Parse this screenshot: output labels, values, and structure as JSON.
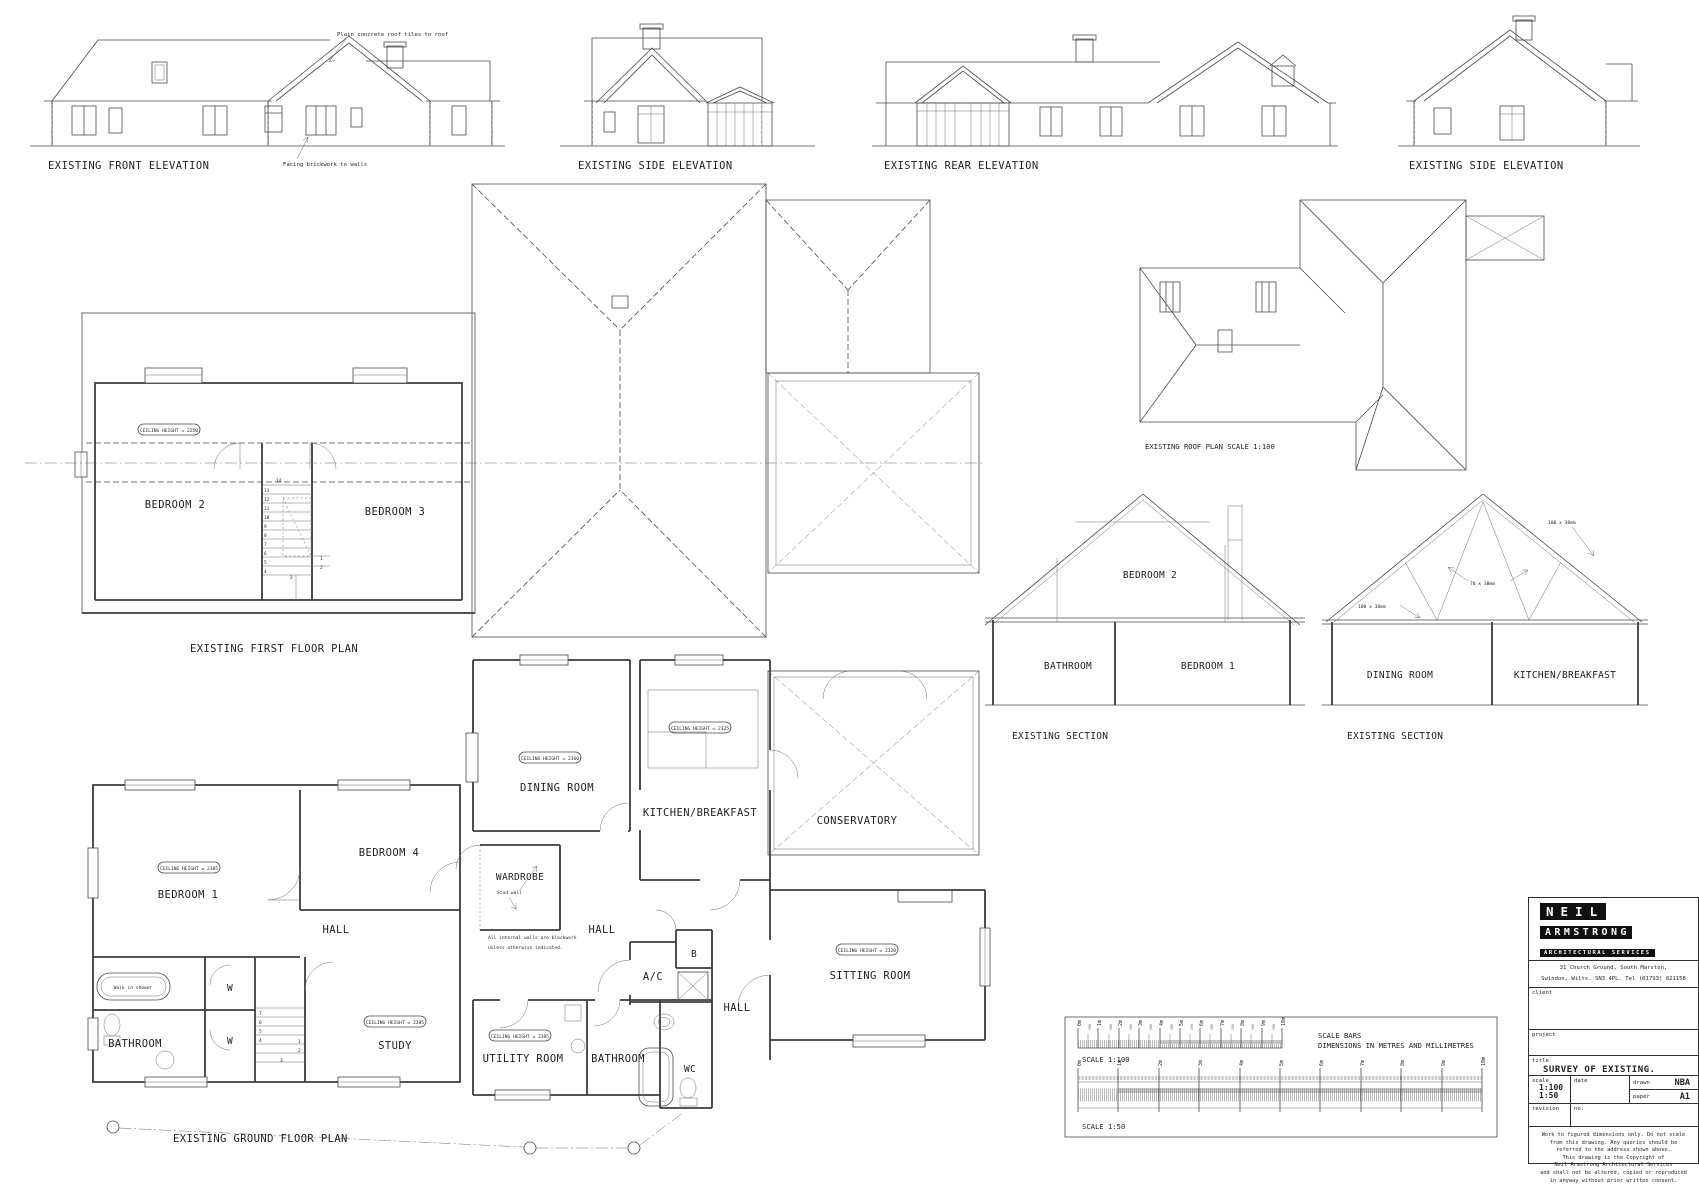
{
  "colors": {
    "line": "#4a4a4a",
    "paper": "#ffffff",
    "logo_bg": "#101010"
  },
  "elevations": {
    "front": {
      "label": "EXISTING FRONT ELEVATION",
      "note_roof": "Plain concrete roof tiles to roof",
      "note_walls": "Facing brickwork to walls"
    },
    "side_left": {
      "label": "EXISTING SIDE ELEVATION"
    },
    "rear": {
      "label": "EXISTING REAR ELEVATION"
    },
    "side_right": {
      "label": "EXISTING SIDE ELEVATION"
    }
  },
  "first_floor": {
    "label": "EXISTING FIRST FLOOR PLAN",
    "bedroom2": "BEDROOM 2",
    "bedroom3": "BEDROOM 3",
    "ceiling_note": "CEILING HEIGHT = 2250",
    "stairs": {
      "top": "14",
      "column": [
        "13",
        "12",
        "11",
        "10",
        "9",
        "8",
        "7",
        "6",
        "5",
        "4"
      ],
      "bottom": [
        "1",
        "2",
        "3"
      ]
    }
  },
  "roof_plan": {
    "label": "EXISTING ROOF PLAN SCALE 1:100"
  },
  "sections": {
    "left": {
      "label": "EXIST1NG SECTION",
      "bedroom2": "BEDROOM 2",
      "bathroom": "BATHROOM",
      "bedroom1": "BEDROOM 1"
    },
    "right": {
      "label": "EXISTING SECTION",
      "dining": "DINING ROOM",
      "kitchen": "KITCHEN/BREAKFAST",
      "timber1": "100 x 38mm",
      "timber2": "70 x 38mm",
      "timber3": "100 x 38mm"
    }
  },
  "ground_floor": {
    "label": "EXISTING GROUND FLOOR PLAN",
    "rooms": {
      "bedroom1": "BEDROOM 1",
      "bedroom4": "BEDROOM 4",
      "hall_left": "HALL",
      "bathroom_left": "BATHROOM",
      "study": "STUDY",
      "w": "W",
      "dining": "DINING ROOM",
      "kitchen": "KITCHEN/BREAKFAST",
      "conservatory": "CONSERVATORY",
      "sitting": "SITTING ROOM",
      "wardrobe": "WARDROBE",
      "hall_centre": "HALL",
      "hall_right": "HALL",
      "ac": "A/C",
      "b": "B",
      "utility": "UTILITY ROOM",
      "bathroom_centre": "BATHROOM",
      "wc": "WC"
    },
    "ceiling_notes": {
      "bedroom1": "CEILING HEIGHT = 2385",
      "study": "CEILING HEIGHT = 2385",
      "dining": "CEILING HEIGHT = 2360",
      "kitchen": "CEILING HEIGHT = 2325",
      "utility": "CEILING HEIGHT = 2385",
      "sitting": "CEILING HEIGHT = 2320"
    },
    "notes": {
      "shower": "Walk in shower",
      "stud": "Stud wall",
      "blockwork1": "All internal walls are blockwork",
      "blockwork2": "unless otherwise indicated."
    },
    "stairs": {
      "column": [
        "7",
        "6",
        "5",
        "4"
      ],
      "bottom": [
        "1",
        "2",
        "3"
      ]
    }
  },
  "scale_bars": {
    "heading1": "SCALE BARS",
    "heading2": "DIMENSIONS IN METRES AND MILLIMETRES",
    "bar100_label": "SCALE 1:100",
    "bar50_label": "SCALE 1:50",
    "ticks": [
      "0m",
      "1m",
      "2m",
      "3m",
      "4m",
      "5m",
      "6m",
      "7m",
      "8m",
      "9m",
      "10m"
    ],
    "minor": "500"
  },
  "title_block": {
    "name1": "NEIL",
    "name2": "ARMSTRONG",
    "name3": "ARCHITECTURAL SERVICES",
    "address1": "31 Church Ground, South Marston,",
    "address2": "Swindon, Wilts. SN3 4PL. Tel (01793) 821158",
    "client_label": "client",
    "project_label": "project",
    "title_label": "title",
    "drawing_title": "SURVEY OF EXISTING.",
    "scale_label": "scale",
    "scale1": "1:100",
    "scale2": "1:50",
    "date_label": "date",
    "drawn_label": "drawn",
    "drawn": "NBA",
    "paper_label": "paper",
    "paper": "A1",
    "revision_label": "revision",
    "no_label": "no.",
    "disclaimer": [
      "Work to figured dimensions only. Do not scale",
      "from this drawing. Any queries should be",
      "referred to the address shown above.",
      "This drawing is the Copyright of",
      "Neil Armstrong Architectural Services",
      "and shall not be altered, copied or reproduced",
      "in anyway without prior written consent."
    ]
  }
}
